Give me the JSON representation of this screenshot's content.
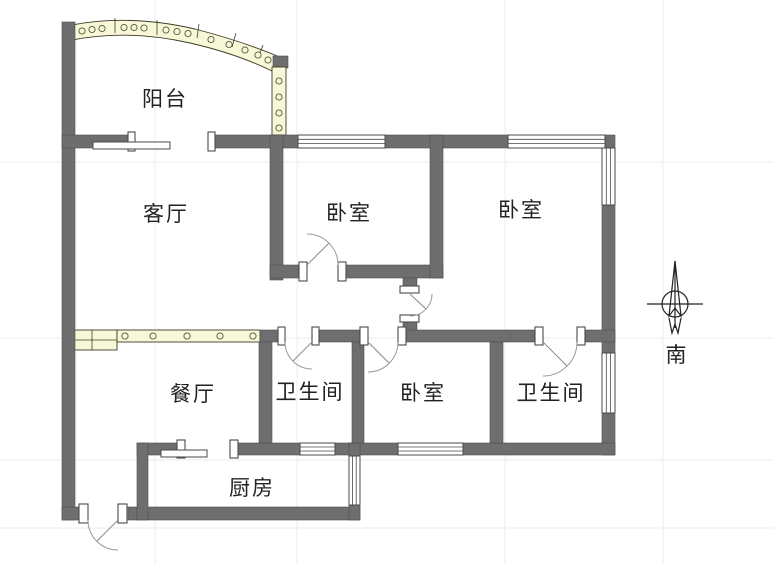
{
  "labels": {
    "balcony": "阳台",
    "living_room": "客厅",
    "bedroom_top_middle": "卧室",
    "bedroom_top_right": "卧室",
    "dining_room": "餐厅",
    "bathroom_left": "卫生间",
    "bedroom_bottom": "卧室",
    "bathroom_right": "卫生间",
    "kitchen": "厨房",
    "compass_south": "南"
  },
  "colors": {
    "wall": "#6e6e6e",
    "window_band": "#f8f8d8",
    "band_outline": "#3c3c28",
    "door_arc": "#9a9a9a",
    "text": "#222222",
    "background": "#ffffff"
  }
}
